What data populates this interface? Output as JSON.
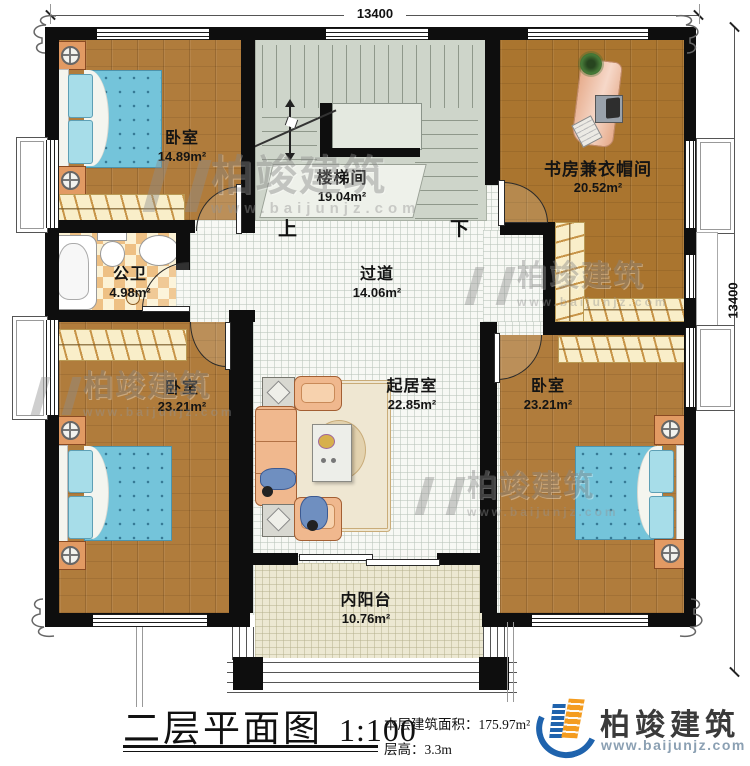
{
  "dimensions": {
    "top": "13400",
    "right": "13400"
  },
  "rooms": [
    {
      "key": "bedroom_top_left",
      "name": "卧室",
      "area": "14.89m²"
    },
    {
      "key": "stairwell",
      "name": "楼梯间",
      "area": "19.04m²"
    },
    {
      "key": "study_cloakroom",
      "name": "书房兼衣帽间",
      "area": "20.52m²"
    },
    {
      "key": "bathroom",
      "name": "公卫",
      "area": "4.98m²"
    },
    {
      "key": "hallway",
      "name": "过道",
      "area": "14.06m²"
    },
    {
      "key": "living_room",
      "name": "起居室",
      "area": "22.85m²"
    },
    {
      "key": "bedroom_bottom_left",
      "name": "卧室",
      "area": "23.21m²"
    },
    {
      "key": "bedroom_bottom_right",
      "name": "卧室",
      "area": "23.21m²"
    },
    {
      "key": "balcony",
      "name": "内阳台",
      "area": "10.76m²"
    }
  ],
  "stairs": {
    "up": "上",
    "down": "下"
  },
  "titleblock": {
    "title": "二层平面图",
    "scale": "1:100",
    "area_line": "本层建筑面积：175.97m²",
    "height_line": "层高：3.3m"
  },
  "brand": {
    "name": "柏竣建筑",
    "url": "www.baijunjz.com"
  },
  "watermark": {
    "name": "柏竣建筑",
    "url": "www.baijunjz.com"
  },
  "colors": {
    "wall": "#0e0e0e",
    "wood": "#b07c3c",
    "stair_floor": "#ced5ca",
    "tile_a": "#eec084",
    "tile_b": "#fcf2d5",
    "bed_blue": "#74c4da",
    "brand_blue": "#1f63ad",
    "brand_orange": "#f49c1f"
  }
}
